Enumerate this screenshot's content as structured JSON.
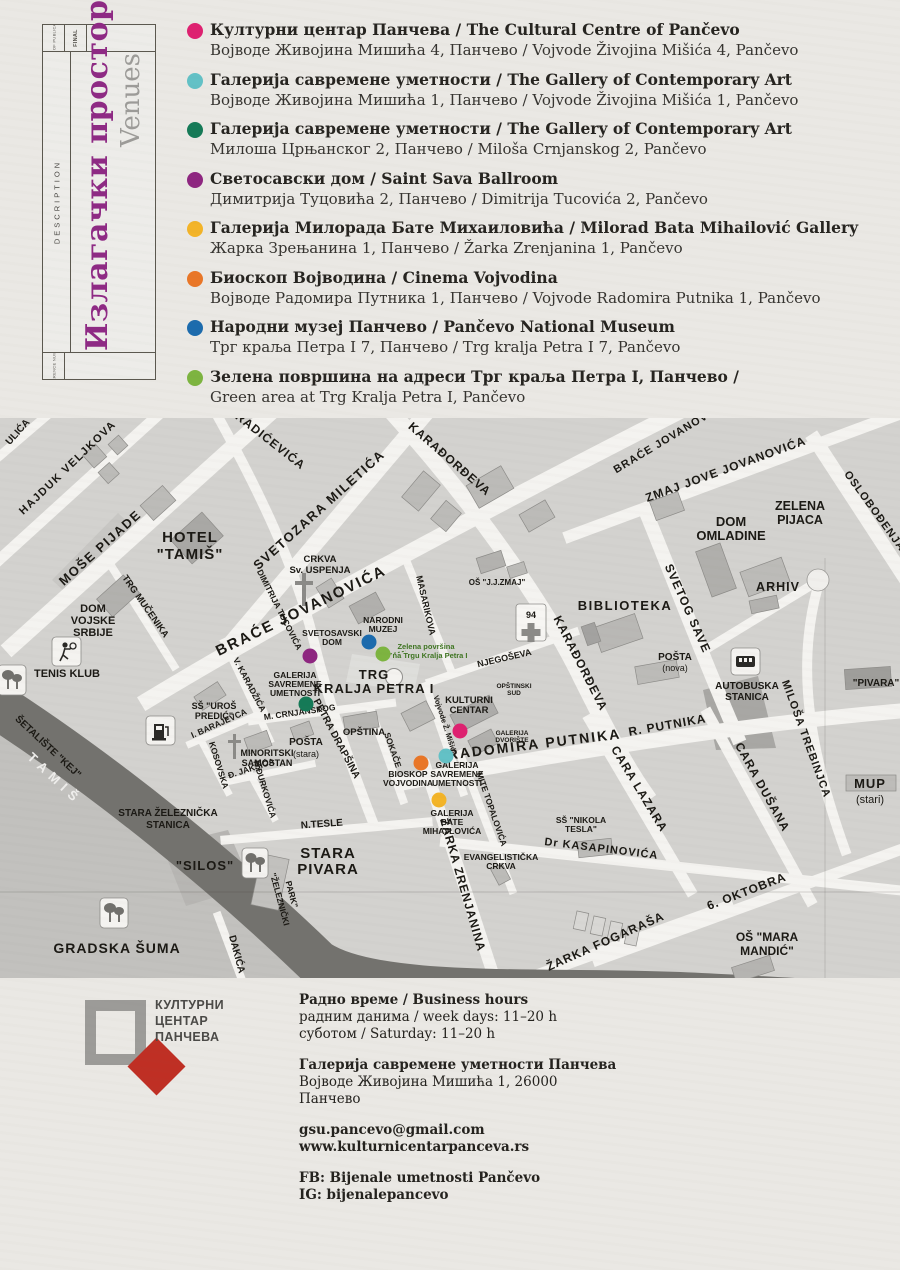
{
  "sidebar": {
    "date_label": "DATE OF PUBLICATION",
    "final_label": "FINAL",
    "description_label": "DESCRIPTION",
    "reference_label": "REFERENCE NUMBER",
    "title_sr": "Излагачки простори",
    "title_en": "Venues",
    "title_color": "#8e2a84"
  },
  "legend": {
    "items": [
      {
        "color": "#de2170",
        "bold": "Културни центар Панчева / The Cultural Centre of Pančevo",
        "normal": "Војводе Живојина Мишића 4, Панчево / Vojvode Živojina Mišića 4, Pančevo"
      },
      {
        "color": "#63c1c6",
        "bold": "Галерија савремене уметности / The Gallery of Contemporary Art",
        "normal": "Војводе Живојина Мишића 1, Панчево / Vojvode Živojina Mišića 1, Pančevo"
      },
      {
        "color": "#157a57",
        "bold": "Галерија савремене уметности / The Gallery of Contemporary Art",
        "normal": "Милоша Црњанског 2, Панчево / Miloša Crnjanskog 2, Pančevo"
      },
      {
        "color": "#8e2680",
        "bold": "Светосавски дом / Saint Sava Ballroom",
        "normal": "Димитрија Туцовића 2, Панчево / Dimitrija Tucovića 2, Pančevo"
      },
      {
        "color": "#f3b428",
        "bold": "Галерија Милорада Бате Михаиловића / Milorad Bata Mihailović Gallery",
        "normal": "Жарка Зрењанина 1, Панчево / Žarka Zrenjanina 1, Pančevo"
      },
      {
        "color": "#e97627",
        "bold": "Биоскоп Војводина / Cinema Vojvodina",
        "normal": "Војводе Радомира Путника 1, Панчево / Vojvode Radomira Putnika 1, Pančevo"
      },
      {
        "color": "#1c6bad",
        "bold": "Народни музеј Панчево / Pančevo National Museum",
        "normal": "Трг краља Петра I 7, Панчево / Trg kralja Petra I 7, Pančevo"
      },
      {
        "color": "#7db440",
        "bold": "Зелена површина на адреси Трг краља Петра I, Панчево /",
        "normal": "Green area at Trg Kralja Petra I, Pančevo"
      }
    ]
  },
  "map": {
    "label_color": "#1b1914",
    "icons": [
      "tree-icon",
      "tennis-icon",
      "fuel-icon",
      "church-cross-icon",
      "hospital-cross-icon",
      "bus-icon",
      "fountain-icon",
      "roundabout-icon"
    ],
    "venue_dots": [
      {
        "id": "svetosavski-dom",
        "x": 310,
        "y": 238,
        "color": "#8e2680"
      },
      {
        "id": "narodni-muzej",
        "x": 369,
        "y": 224,
        "color": "#1c6bad"
      },
      {
        "id": "zelena-povrsina",
        "x": 383,
        "y": 236,
        "color": "#7db440"
      },
      {
        "id": "galerija-savremene-crnjanskog",
        "x": 306,
        "y": 286,
        "color": "#157a57"
      },
      {
        "id": "kulturni-centar",
        "x": 460,
        "y": 313,
        "color": "#de2170"
      },
      {
        "id": "galerija-savremene-misica",
        "x": 446,
        "y": 338,
        "color": "#63c1c6"
      },
      {
        "id": "bioskop-vojvodina",
        "x": 421,
        "y": 345,
        "color": "#e97627"
      },
      {
        "id": "galerija-bate-mihajlovica",
        "x": 439,
        "y": 382,
        "color": "#f3b428"
      }
    ],
    "labels": [
      {
        "t": "ULIĆA",
        "x": 20,
        "y": 16,
        "r": -48,
        "s": 10
      },
      {
        "t": "HAJDUK VELJKOVA",
        "x": 70,
        "y": 52,
        "r": -44,
        "s": 11,
        "ls": 1.5
      },
      {
        "t": "MOŠE PIJADE",
        "x": 103,
        "y": 133,
        "r": -42,
        "s": 13,
        "ls": 1.5
      },
      {
        "t": "SVETOZARA MILETIĆA",
        "x": 322,
        "y": 95,
        "r": -42,
        "s": 13,
        "ls": 1.5
      },
      {
        "t": "RADIĆEVIĆA",
        "x": 268,
        "y": 26,
        "r": 38,
        "s": 12,
        "ls": 1
      },
      {
        "t": "KARAĐORĐEVA",
        "x": 447,
        "y": 44,
        "r": 41,
        "s": 12,
        "ls": 1
      },
      {
        "t": "KARAĐORĐEVA",
        "x": 577,
        "y": 247,
        "r": 63,
        "s": 12,
        "ls": 1
      },
      {
        "t": "BRAĆE JOVANOVIĆA",
        "x": 303,
        "y": 197,
        "r": -26,
        "s": 15,
        "ls": 2
      },
      {
        "t": "BRAĆE JOVANOVIĆA",
        "x": 672,
        "y": 22,
        "r": -31,
        "s": 11,
        "ls": 1
      },
      {
        "t": "ZMAJ JOVE JOVANOVIĆA",
        "x": 727,
        "y": 55,
        "r": -20,
        "s": 12,
        "ls": 1
      },
      {
        "t": "DIMITRIJA TUCOVIĆA",
        "x": 277,
        "y": 193,
        "r": 63,
        "s": 8.5
      },
      {
        "t": "TRG MUČENIKA",
        "x": 143,
        "y": 190,
        "r": 55,
        "s": 9.5
      },
      {
        "t": "SVETOG SAVE",
        "x": 684,
        "y": 192,
        "r": 66,
        "s": 12,
        "ls": 1
      },
      {
        "t": "MASARIKOVA",
        "x": 423,
        "y": 188,
        "r": 77,
        "s": 9
      },
      {
        "t": "NJEGOŠEVA",
        "x": 505,
        "y": 243,
        "r": -13,
        "s": 9
      },
      {
        "t": "OSLOBOĐENJA",
        "x": 872,
        "y": 95,
        "r": 54,
        "s": 11,
        "ls": 1
      },
      {
        "t": "RADOMIRA PUTNIKA",
        "x": 535,
        "y": 331,
        "r": -7,
        "s": 14,
        "ls": 2
      },
      {
        "t": "R. PUTNIKA",
        "x": 668,
        "y": 311,
        "r": -10,
        "s": 12,
        "ls": 1
      },
      {
        "t": "CARA LAZARA",
        "x": 636,
        "y": 373,
        "r": 59,
        "s": 12,
        "ls": 1
      },
      {
        "t": "CARA DUŠANA",
        "x": 759,
        "y": 371,
        "r": 61,
        "s": 12,
        "ls": 1
      },
      {
        "t": "MILOŠA TREBINJCA",
        "x": 803,
        "y": 322,
        "r": 70,
        "s": 11,
        "ls": 1
      },
      {
        "t": "Dr KASAPINOVIĆA",
        "x": 601,
        "y": 434,
        "r": 7,
        "s": 11,
        "ls": 1
      },
      {
        "t": "6. OKTOBRA",
        "x": 748,
        "y": 477,
        "r": -21,
        "s": 12,
        "ls": 1
      },
      {
        "t": "ŽARKA FOGARAŠA",
        "x": 607,
        "y": 527,
        "r": -24,
        "s": 12,
        "ls": 1
      },
      {
        "t": "N.TESLE",
        "x": 322,
        "y": 409,
        "r": -4,
        "s": 10
      },
      {
        "t": "ŽARKA ZRENJANINA",
        "x": 459,
        "y": 468,
        "r": 74,
        "s": 12,
        "ls": 1
      },
      {
        "t": "MITE TOPALOVIĆA",
        "x": 489,
        "y": 392,
        "r": 71,
        "s": 8.5
      },
      {
        "t": "Vojvode Ž. Mišića",
        "x": 443,
        "y": 308,
        "r": 72,
        "s": 7.5
      },
      {
        "t": "SOKAČE",
        "x": 390,
        "y": 333,
        "r": 71,
        "s": 8.5
      },
      {
        "t": "PETRA DRAPŠINA",
        "x": 334,
        "y": 322,
        "r": 62,
        "s": 10
      },
      {
        "t": "V. KARADŽIĆA",
        "x": 247,
        "y": 268,
        "r": 62,
        "s": 8.5
      },
      {
        "t": "M. CRNJANSKOG",
        "x": 300,
        "y": 297,
        "r": -8,
        "s": 8.5
      },
      {
        "t": "I. BARAJEVCA",
        "x": 220,
        "y": 308,
        "r": -24,
        "s": 8.5
      },
      {
        "t": "KOSOVSKA",
        "x": 216,
        "y": 348,
        "r": 73,
        "s": 8.5
      },
      {
        "t": "Đ. JAKŠIĆA",
        "x": 252,
        "y": 353,
        "r": -18,
        "s": 8.5
      },
      {
        "t": "N.ĐURKOVIĆA",
        "x": 262,
        "y": 372,
        "r": 73,
        "s": 8.5
      },
      {
        "t": "DAKIĆA",
        "x": 234,
        "y": 537,
        "r": 75,
        "s": 10
      },
      {
        "t": "ŠETALIŠTE \"KEJ\"",
        "x": 46,
        "y": 331,
        "r": 43,
        "s": 10
      },
      {
        "t": "TAMIŠ",
        "x": 52,
        "y": 364,
        "r": 43,
        "s": 13,
        "c": "#efeeec",
        "ls": 6
      },
      {
        "t": "HOTEL",
        "x": 190,
        "y": 124,
        "s": 15,
        "ls": 1
      },
      {
        "t": "\"TAMIŠ\"",
        "x": 190,
        "y": 141,
        "s": 15,
        "ls": 1
      },
      {
        "t": "CRKVA",
        "x": 320,
        "y": 144,
        "s": 9.5
      },
      {
        "t": "Sv. USPENJA",
        "x": 320,
        "y": 155,
        "s": 9.5
      },
      {
        "t": "DOM",
        "x": 93,
        "y": 194,
        "s": 11
      },
      {
        "t": "VOJSKE",
        "x": 93,
        "y": 206,
        "s": 11
      },
      {
        "t": "SRBIJE",
        "x": 93,
        "y": 218,
        "s": 11
      },
      {
        "t": "TENIS KLUB",
        "x": 67,
        "y": 259,
        "s": 11
      },
      {
        "t": "DOM",
        "x": 731,
        "y": 108,
        "s": 13
      },
      {
        "t": "OMLADINE",
        "x": 731,
        "y": 122,
        "s": 13
      },
      {
        "t": "ZELENA",
        "x": 800,
        "y": 92,
        "s": 12.5
      },
      {
        "t": "PIJACA",
        "x": 800,
        "y": 106,
        "s": 12.5
      },
      {
        "t": "ARHIV",
        "x": 778,
        "y": 173,
        "s": 12.5,
        "ls": 1
      },
      {
        "t": "BIBLIOTEKA",
        "x": 625,
        "y": 192,
        "s": 13,
        "ls": 1.5
      },
      {
        "t": "OŠ \"J.J.ZMAJ\"",
        "x": 497,
        "y": 167,
        "s": 8
      },
      {
        "t": "94",
        "x": 531,
        "y": 200,
        "s": 9
      },
      {
        "t": "POŠTA",
        "x": 675,
        "y": 242,
        "s": 10
      },
      {
        "t": "(nova)",
        "x": 675,
        "y": 253,
        "s": 9,
        "w": "n"
      },
      {
        "t": "AUTOBUSKA",
        "x": 747,
        "y": 271,
        "s": 10
      },
      {
        "t": "STANICA",
        "x": 747,
        "y": 282,
        "s": 10
      },
      {
        "t": "\"PIVARA\"",
        "x": 876,
        "y": 268,
        "s": 10
      },
      {
        "t": "MUP",
        "x": 870,
        "y": 370,
        "s": 13,
        "ls": 1
      },
      {
        "t": "(stari)",
        "x": 870,
        "y": 385,
        "s": 11,
        "w": "n"
      },
      {
        "t": "SŠ \"UROŠ",
        "x": 214,
        "y": 291,
        "s": 9
      },
      {
        "t": "PREDIĆ\"",
        "x": 214,
        "y": 301,
        "s": 9
      },
      {
        "t": "MINORITSKI",
        "x": 267,
        "y": 338,
        "s": 9
      },
      {
        "t": "SAMOSTAN",
        "x": 267,
        "y": 348,
        "s": 9
      },
      {
        "t": "POŠTA",
        "x": 306,
        "y": 327,
        "s": 10
      },
      {
        "t": "(stara)",
        "x": 306,
        "y": 339,
        "s": 9,
        "w": "n"
      },
      {
        "t": "OPŠTINA",
        "x": 364,
        "y": 317,
        "s": 9.5
      },
      {
        "t": "TRG",
        "x": 374,
        "y": 261,
        "s": 13,
        "ls": 1
      },
      {
        "t": "KRALJA PETRA I",
        "x": 374,
        "y": 275,
        "s": 13,
        "ls": 1
      },
      {
        "t": "KULTURNI",
        "x": 469,
        "y": 285,
        "s": 9.5
      },
      {
        "t": "CENTAR",
        "x": 469,
        "y": 295,
        "s": 9.5
      },
      {
        "t": "OPŠTINSKI",
        "x": 514,
        "y": 270,
        "s": 6.5
      },
      {
        "t": "SUD",
        "x": 514,
        "y": 277,
        "s": 6.5
      },
      {
        "t": "GALERIJA",
        "x": 512,
        "y": 317,
        "s": 6.5
      },
      {
        "t": "DVORIŠTE",
        "x": 512,
        "y": 324,
        "s": 6.5
      },
      {
        "t": "NARODNI",
        "x": 383,
        "y": 205,
        "s": 8.5
      },
      {
        "t": "MUZEJ",
        "x": 383,
        "y": 214,
        "s": 8.5
      },
      {
        "t": "SVETOSAVSKI",
        "x": 332,
        "y": 218,
        "s": 8.5
      },
      {
        "t": "DOM",
        "x": 332,
        "y": 227,
        "s": 8.5
      },
      {
        "t": "Zelena površina",
        "x": 426,
        "y": 231,
        "s": 7.5,
        "c": "#3f7522"
      },
      {
        "t": "na Trgu Kralja Petra I",
        "x": 430,
        "y": 240,
        "s": 7.5,
        "c": "#3f7522"
      },
      {
        "t": "GALERIJA",
        "x": 295,
        "y": 260,
        "s": 8.5
      },
      {
        "t": "SAVREMENE",
        "x": 295,
        "y": 269,
        "s": 8.5
      },
      {
        "t": "UMETNOSTI",
        "x": 295,
        "y": 278,
        "s": 8.5
      },
      {
        "t": "BIOSKOP",
        "x": 408,
        "y": 359,
        "s": 8.5
      },
      {
        "t": "VOJVODINA",
        "x": 408,
        "y": 368,
        "s": 8.5
      },
      {
        "t": "GALERIJA",
        "x": 457,
        "y": 350,
        "s": 8.5
      },
      {
        "t": "SAVREMENE",
        "x": 457,
        "y": 359,
        "s": 8.5
      },
      {
        "t": "UMETNOSTI",
        "x": 457,
        "y": 368,
        "s": 8.5
      },
      {
        "t": "GALERIJA",
        "x": 452,
        "y": 398,
        "s": 8.5
      },
      {
        "t": "BATE",
        "x": 452,
        "y": 407,
        "s": 8.5
      },
      {
        "t": "MIHAJLOVIĆA",
        "x": 452,
        "y": 416,
        "s": 8.5
      },
      {
        "t": "EVANGELISTIČKA",
        "x": 501,
        "y": 442,
        "s": 8.5
      },
      {
        "t": "CRKVA",
        "x": 501,
        "y": 451,
        "s": 8.5
      },
      {
        "t": "SŠ \"NIKOLA",
        "x": 581,
        "y": 405,
        "s": 8.5
      },
      {
        "t": "TESLA\"",
        "x": 581,
        "y": 414,
        "s": 8.5
      },
      {
        "t": "OŠ \"MARA",
        "x": 767,
        "y": 523,
        "s": 12
      },
      {
        "t": "MANDIĆ\"",
        "x": 767,
        "y": 537,
        "s": 12
      },
      {
        "t": "STARA",
        "x": 328,
        "y": 440,
        "s": 15,
        "ls": 1
      },
      {
        "t": "PIVARA",
        "x": 328,
        "y": 456,
        "s": 15,
        "ls": 1
      },
      {
        "t": "\"SILOS\"",
        "x": 205,
        "y": 452,
        "s": 13,
        "ls": 1
      },
      {
        "t": "STARA ŽELEZNIČKA",
        "x": 168,
        "y": 398,
        "s": 10
      },
      {
        "t": "STANICA",
        "x": 168,
        "y": 410,
        "s": 10
      },
      {
        "t": "GRADSKA ŠUMA",
        "x": 117,
        "y": 535,
        "s": 14,
        "ls": 1
      },
      {
        "t": "\"ŽELEZNIČKI",
        "x": 277,
        "y": 482,
        "r": 75,
        "s": 8.5
      },
      {
        "t": "PARK\"",
        "x": 289,
        "y": 477,
        "r": 75,
        "s": 8.5
      }
    ]
  },
  "footer": {
    "logo_line1": "КУЛТУРНИ",
    "logo_line2": "ЦЕНТАР",
    "logo_line3": "ПАНЧЕВА",
    "hours_title": "Радно време / Business hours",
    "hours_week": "радним данима / week days: 11–20 h",
    "hours_sat": "суботом / Saturday: 11–20 h",
    "gallery_name": "Галерија савремене уметности Панчева",
    "gallery_addr1": "Војводе Живојина Мишића 1, 26000",
    "gallery_addr2": "Панчево",
    "email": "gsu.pancevo@gmail.com",
    "website": "www.kulturnicentarpanceva.rs",
    "fb": "FB: Bijenale umetnosti Pančevo",
    "ig": "IG: bijenalepancevo"
  }
}
